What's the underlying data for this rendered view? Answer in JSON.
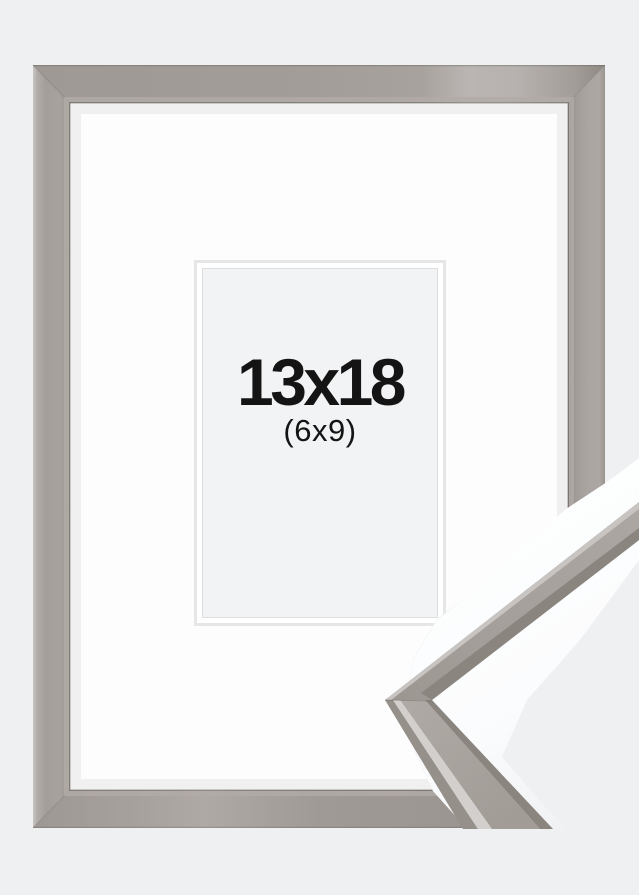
{
  "product_photo": {
    "size_label": "13x18",
    "secondary_size_label": "(6x9)",
    "colors": {
      "page_background": "#eef0f1",
      "frame_face": "#a7a19d",
      "frame_shadow": "#938d89",
      "frame_highlight": "#c9c5c2",
      "mat_white": "#fdfdfe",
      "opening_bevel": "#ffffff",
      "opening_panel": "#f2f3f4",
      "label_text": "#141414",
      "detail_paper": "#fcfdfe",
      "moulding_main": "#a59f9a",
      "moulding_highlight": "#d2cfcc",
      "moulding_edge_light": "#c8c4c1",
      "moulding_shadow": "#96908b",
      "moulding_dark": "#8b8580"
    }
  }
}
